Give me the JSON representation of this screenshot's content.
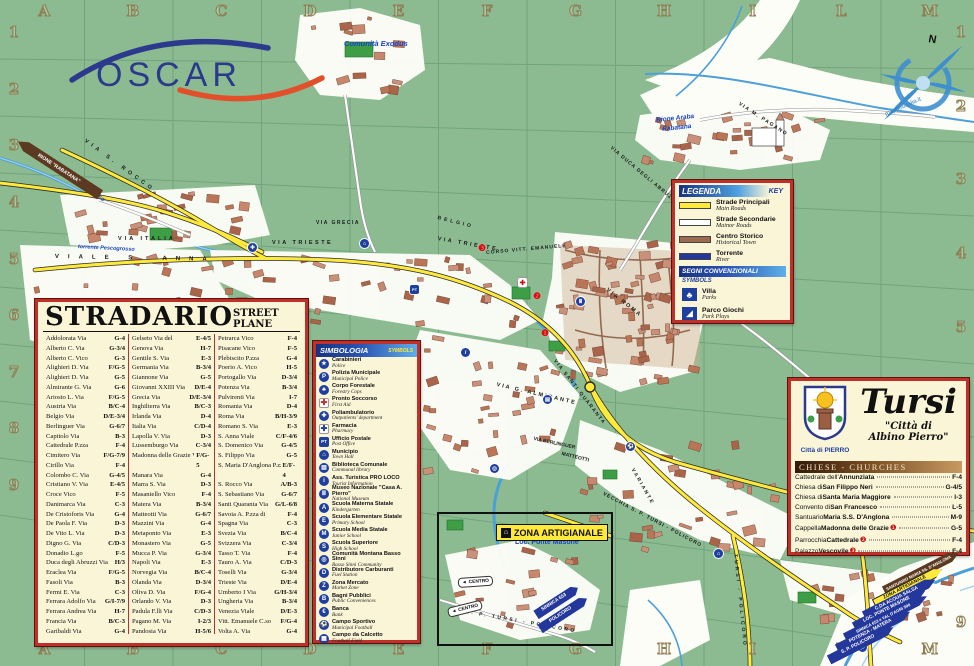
{
  "logo": {
    "text": "OSCAR"
  },
  "compass": {
    "north": "N",
    "credit": "mappeditalia.it"
  },
  "grid": {
    "cols": [
      "A",
      "B",
      "C",
      "D",
      "E",
      "F",
      "G",
      "H",
      "I",
      "L",
      "M"
    ],
    "rows": [
      "1",
      "2",
      "3",
      "4",
      "5",
      "6",
      "7",
      "8",
      "9"
    ]
  },
  "stradario": {
    "title": "STRADARIO",
    "subtitle": "STREET PLANE",
    "col1": [
      [
        "Addolorata Via",
        "G-4"
      ],
      [
        "Alberto C. Via",
        "G-3/4"
      ],
      [
        "Alberto C. Vico",
        "G-3"
      ],
      [
        "Alighieri D. Via",
        "F/G-5"
      ],
      [
        "Alighieri D. Via",
        "G-5"
      ],
      [
        "Almirante G. Via",
        "G-6"
      ],
      [
        "Ariosto L. Via",
        "F/G-5"
      ],
      [
        "Austria Via",
        "B/C-4"
      ],
      [
        "Belgio Via",
        "D/E-3/4"
      ],
      [
        "Berlinguer Via",
        "G-6/7"
      ],
      [
        "Capitolo Via",
        "B-3"
      ],
      [
        "Cattedrale P.zza",
        "F-4"
      ],
      [
        "Cimitero Via",
        "F/G-7/9"
      ],
      [
        "Cirillo Via",
        "F-4"
      ],
      [
        "Colombo C. Via",
        "G-4/5"
      ],
      [
        "Cristiano V. Via",
        "E-4/5"
      ],
      [
        "Croce Vico",
        "F-5"
      ],
      [
        "Danimarca Via",
        "C-3"
      ],
      [
        "De Cristoforis Via",
        "G-4"
      ],
      [
        "De Paola F. Via",
        "D-3"
      ],
      [
        "De Vito L. Via",
        "D-3"
      ],
      [
        "Digno G. Via",
        "C/D-3"
      ],
      [
        "Donadio L.go",
        "F-5"
      ],
      [
        "Duca degli Abruzzi Via",
        "H/3"
      ],
      [
        "Eraclea Via",
        "F/G-5"
      ],
      [
        "Fasoli Via",
        "B-3"
      ],
      [
        "Fermi E. Via",
        "C-3"
      ],
      [
        "Ferrara Adolfo Via",
        "G/I-7/9"
      ],
      [
        "Ferrara Andrea Via",
        "H-7"
      ],
      [
        "Francia Via",
        "B/C-3"
      ],
      [
        "Garibaldi Via",
        "G-4"
      ]
    ],
    "col2": [
      [
        "Gelseto Via del",
        "E-4/5"
      ],
      [
        "Genova Via",
        "H-7"
      ],
      [
        "Gentile S. Via",
        "E-3"
      ],
      [
        "Germania Via",
        "B-3/4"
      ],
      [
        "Giannone Via",
        "G-5"
      ],
      [
        "Giovanni XXIII Via",
        "D/E-4"
      ],
      [
        "Grecia Via",
        "D/E-3/4"
      ],
      [
        "Inghilterra Via",
        "B/C-3"
      ],
      [
        "Irlanda Via",
        "D-4"
      ],
      [
        "Italia Via",
        "C/D-4"
      ],
      [
        "Lapolla V. Via",
        "D-3"
      ],
      [
        "Lussemburgo Via",
        "C-3/4"
      ],
      [
        "Madonna delle Grazie Via",
        "F/G-5"
      ],
      [
        "Manara Via",
        "G-4"
      ],
      [
        "Marra S. Via",
        "D-3"
      ],
      [
        "Masaniello Vico",
        "F-4"
      ],
      [
        "Matera Via",
        "B-3/4"
      ],
      [
        "Matteotti Via",
        "G-6/7"
      ],
      [
        "Mazzini Via",
        "G-4"
      ],
      [
        "Metaponto Via",
        "E-3"
      ],
      [
        "Monastero Via",
        "G-5"
      ],
      [
        "Mucca P. Via",
        "G-3/4"
      ],
      [
        "Napoli Via",
        "E-3"
      ],
      [
        "Norvegia Via",
        "B/C-4"
      ],
      [
        "Olanda Via",
        "D-3/4"
      ],
      [
        "Oliva D. Via",
        "F/G-4"
      ],
      [
        "Orlando V. Via",
        "D-3"
      ],
      [
        "Padula F.lli Via",
        "C/D-3"
      ],
      [
        "Pagano M. Via",
        "I-2/3"
      ],
      [
        "Pandosia Via",
        "H-5/6"
      ],
      [
        "Petrarca Via",
        "F-4"
      ]
    ],
    "col3": [
      [
        "Petrarca Vico",
        "F-4"
      ],
      [
        "Pisacane Vico",
        "F-5"
      ],
      [
        "Plebiscito P.zza",
        "G-4"
      ],
      [
        "Poerio A. Vico",
        "H-5"
      ],
      [
        "Portogallo Via",
        "D-3/4"
      ],
      [
        "Potenza Via",
        "B-3/4"
      ],
      [
        "Pulvirenti Via",
        "I-7"
      ],
      [
        "Romania Via",
        "D-4"
      ],
      [
        "Roma Via",
        "B/H-3/9"
      ],
      [
        "Romano S. Via",
        "E-3"
      ],
      [
        "S. Anna Viale",
        "C/F-4/6"
      ],
      [
        "S. Domenico Via",
        "G-4/5"
      ],
      [
        "S. Filippo Via",
        "G-5"
      ],
      [
        "S. Maria D'Anglona P.zza",
        "E/F-4"
      ],
      [
        "S. Rocco Via",
        "A/B-3"
      ],
      [
        "S. Sebastiano Via",
        "G-6/7"
      ],
      [
        "Santi Quaranta Via",
        "G/L-6/8"
      ],
      [
        "Savoia A. P.zza di",
        "F-4"
      ],
      [
        "Spagna Via",
        "C-3"
      ],
      [
        "Svezia Via",
        "B/C-4"
      ],
      [
        "Svizzera Via",
        "C-3/4"
      ],
      [
        "Tasso T. Via",
        "F-4"
      ],
      [
        "Tauro A. Via",
        "C/D-3"
      ],
      [
        "Toselli Via",
        "G-3/4"
      ],
      [
        "Trieste Via",
        "D/E-4"
      ],
      [
        "Umberto I Via",
        "G/H-3/4"
      ],
      [
        "Ungheria Via",
        "B-3/4"
      ],
      [
        "Venezia Viale",
        "D/E-3"
      ],
      [
        "Vitt. Emanuele C.so",
        "F/G-4"
      ],
      [
        "Volta A. Via",
        "G-4"
      ],
      [
        "Zanfrino F.lli Via",
        "E-3/4"
      ]
    ]
  },
  "simbologia": {
    "title": "SIMBOLOGIA",
    "subtitle": "SYMBOLS",
    "items": [
      {
        "it": "Carabinieri",
        "en": "Police",
        "glyph": "★",
        "style": "circle"
      },
      {
        "it": "Polizia Municipale",
        "en": "Municipal Police",
        "glyph": "P",
        "style": "circle"
      },
      {
        "it": "Corpo Forestale",
        "en": "Forestry Cops",
        "glyph": "♣",
        "style": "circle"
      },
      {
        "it": "Pronto Soccorso",
        "en": "First Aid",
        "glyph": "✚",
        "style": "cross"
      },
      {
        "it": "Poliambulatorio",
        "en": "Outpatients' department",
        "glyph": "✚",
        "style": "circle"
      },
      {
        "it": "Farmacia",
        "en": "Pharmacy",
        "glyph": "✚",
        "style": "bluecross"
      },
      {
        "it": "Ufficio Postale",
        "en": "Post Office",
        "glyph": "PT",
        "style": "rect"
      },
      {
        "it": "Municipio",
        "en": "Town Hall",
        "glyph": "⌂",
        "style": "circle"
      },
      {
        "it": "Biblioteca Comunale",
        "en": "Communal library",
        "glyph": "▤",
        "style": "circle"
      },
      {
        "it": "Ass. Turistica PRO LOCO",
        "en": "Tourist Information",
        "glyph": "i",
        "style": "circle"
      },
      {
        "it": "Museo Nazionale \"Casa A. Pierro\"",
        "en": "National Museum",
        "glyph": "Ⅲ",
        "style": "circle"
      },
      {
        "it": "Scuola Materna Statale",
        "en": "Kindergarten",
        "glyph": "A",
        "style": "circle"
      },
      {
        "it": "Scuola Elementare Statale",
        "en": "Primary School",
        "glyph": "E",
        "style": "circle"
      },
      {
        "it": "Scuola Media Statale",
        "en": "Junior School",
        "glyph": "M",
        "style": "circle"
      },
      {
        "it": "Scuola Superiore",
        "en": "High School",
        "glyph": "S",
        "style": "circle"
      },
      {
        "it": "Comunità Montana Basso Sinni",
        "en": "Basso Sinni Community",
        "glyph": "◎",
        "style": "circle"
      },
      {
        "it": "Distributore Carburanti",
        "en": "Fuel Station",
        "glyph": "D",
        "style": "circle"
      },
      {
        "it": "Zona Mercato",
        "en": "Market Zone",
        "glyph": "Z",
        "style": "circle"
      },
      {
        "it": "Bagni Pubblici",
        "en": "Public Conveniences",
        "glyph": "B",
        "style": "circle"
      },
      {
        "it": "Banca",
        "en": "Bank",
        "glyph": "€",
        "style": "circle"
      },
      {
        "it": "Campo Sportivo",
        "en": "Municipal Football",
        "glyph": "⚽",
        "style": "circle"
      },
      {
        "it": "Campo da Calcetto",
        "en": "Football Field",
        "glyph": "▦",
        "style": "circle"
      }
    ]
  },
  "legenda": {
    "title": "LEGENDA",
    "key": "KEY",
    "lines": [
      {
        "it": "Strade Principali",
        "en": "Main Roads",
        "color": "#FFE93B"
      },
      {
        "it": "Strade Secondarie",
        "en": "Mainor Roads",
        "color": "#FFFFFF"
      },
      {
        "it": "Centro Storico",
        "en": "Historical Town",
        "color": "#9C6B4F"
      },
      {
        "it": "Torrente",
        "en": "River",
        "color": "#24379B"
      }
    ],
    "segni_title": "SEGNI CONVENZIONALI",
    "segni_sub": "SYMBOLS",
    "symbols": [
      {
        "it": "Villa",
        "en": "Parks",
        "glyph": "♣"
      },
      {
        "it": "Parco Giochi",
        "en": "Park Plays",
        "glyph": "◢"
      }
    ]
  },
  "tursi": {
    "name": "Tursi",
    "quote1": "\"Città di",
    "quote2": "Albino Pierro\"",
    "crest_caption": "Città di PIERRO",
    "band": "CHIESE - CHURCHES",
    "churches": [
      {
        "prefix": "Cattedrale dell'",
        "name": "Annunziata",
        "mk": "",
        "ref": "F-4"
      },
      {
        "prefix": "Chiesa di ",
        "name": "San Filippo Neri",
        "mk": "",
        "ref": "G-4/5"
      },
      {
        "prefix": "Chiesa di ",
        "name": "Santa Maria Maggiore",
        "mk": "",
        "ref": "I-3"
      },
      {
        "prefix": "Convento di ",
        "name": "San Francesco",
        "mk": "",
        "ref": "L-5"
      },
      {
        "prefix": "Santuario ",
        "name": "Maria S.S. D'Anglona",
        "mk": "",
        "ref": "M-9"
      },
      {
        "prefix": "Cappella ",
        "name": "Madonna delle Grazie",
        "mk": "❶",
        "ref": "G-5"
      },
      {
        "prefix": "Parrocchia ",
        "name": "Cattedrale",
        "mk": "❷",
        "ref": "F-4"
      },
      {
        "prefix": "Palazzo ",
        "name": "Vescovile",
        "mk": "❸",
        "ref": "F-4"
      }
    ]
  },
  "zona": {
    "label": "ZONA ARTIGIANALE",
    "icon": "⌂",
    "loc": "Loc. Ponte Masone"
  },
  "rione_banner": "RIONE \"RABATANA\"",
  "banners": [
    {
      "text": "SANTUARIO MARIA SS. D'ANGLONA",
      "type": "brown"
    },
    {
      "text": "ZONA ARTIGIANALE",
      "type": "yellow"
    },
    {
      "text": "C.DA ACQUA SALSA",
      "type": "blue"
    },
    {
      "text": "LOC. PONTE MASONE",
      "type": "blue"
    },
    {
      "text": "SINNICA 653 e VAL D'AGRI 598",
      "type": "blue"
    },
    {
      "text": "POTENZA - MATERA",
      "type": "blue"
    },
    {
      "text": "S. P. POLICORO",
      "type": "blue"
    }
  ],
  "inset": {
    "centro": "CENTRO",
    "arrow": "◄",
    "sinnica": "SINNICA 653",
    "policoro": "POLICORO"
  },
  "map_labels": [
    {
      "text": "VIA ITALIA"
    },
    {
      "text": "VIA TRIESTE"
    },
    {
      "text": "VIA TRIESTE"
    },
    {
      "text": "VIALE  S.  ANNA"
    },
    {
      "text": "VIA GRECIA"
    },
    {
      "text": "BELGIO"
    },
    {
      "text": "VIA S. ROCCO"
    },
    {
      "text": "VIA G. ALMIRANTE"
    },
    {
      "text": "VIA SANTI QUARANTA"
    },
    {
      "text": "CORSO VITT. EMANUELE"
    },
    {
      "text": "VIA ROMA"
    },
    {
      "text": "VIA DUCA DEGLI ABRUZZI"
    },
    {
      "text": "VIA M. PAGANO"
    },
    {
      "text": "VECCHIA S. P. TURSI - POLICORO"
    },
    {
      "text": "VARIANTE"
    },
    {
      "text": "TURSI - POLICORO"
    },
    {
      "text": "torrente Pescogrosso"
    },
    {
      "text": "torrente Pescogrosso"
    },
    {
      "text": "Comunità Exodus"
    },
    {
      "text": "Rione Araba"
    },
    {
      "text": "Rabatana"
    },
    {
      "text": "Loc. Ponte Masone"
    },
    {
      "text": "VIA BERLINGUER"
    },
    {
      "text": "MATTEOTTI"
    },
    {
      "text": "S. P. TURSI - POLICORO"
    }
  ],
  "map_icons": [
    {
      "name": "farmacia",
      "glyph": "✚",
      "style": "circle"
    },
    {
      "name": "municipio",
      "glyph": "⌂",
      "style": "circle"
    },
    {
      "name": "ufficio-postale",
      "glyph": "PT",
      "style": "rect"
    },
    {
      "name": "pronto-soccorso",
      "glyph": "✚",
      "style": "cross"
    },
    {
      "name": "carabinieri",
      "glyph": "★",
      "style": "circle"
    },
    {
      "name": "museo",
      "glyph": "Ⅲ",
      "style": "circle"
    },
    {
      "name": "campo-sportivo",
      "glyph": "⚽",
      "style": "circle"
    },
    {
      "name": "scuola",
      "glyph": "⌂",
      "style": "circle"
    },
    {
      "name": "bus",
      "glyph": "▶",
      "style": "circle"
    },
    {
      "name": "comunita-montana",
      "glyph": "◎",
      "style": "circle"
    },
    {
      "name": "pro-loco",
      "glyph": "i",
      "style": "circle"
    },
    {
      "name": "biblioteca",
      "glyph": "▤",
      "style": "circle"
    }
  ],
  "markers": [
    "❶",
    "❷",
    "❸"
  ],
  "colors": {
    "map_green": "#8CBB92",
    "grid_line": "#6FA279",
    "road_yellow": "#FFE93B",
    "river_blue": "#4D9FD8",
    "building": "#C6876C",
    "box_cream": "#FBF5D7",
    "box_border_red": "#C03028",
    "band_blue": "#1F3F9F",
    "banner_brown": "#5C3A22"
  }
}
